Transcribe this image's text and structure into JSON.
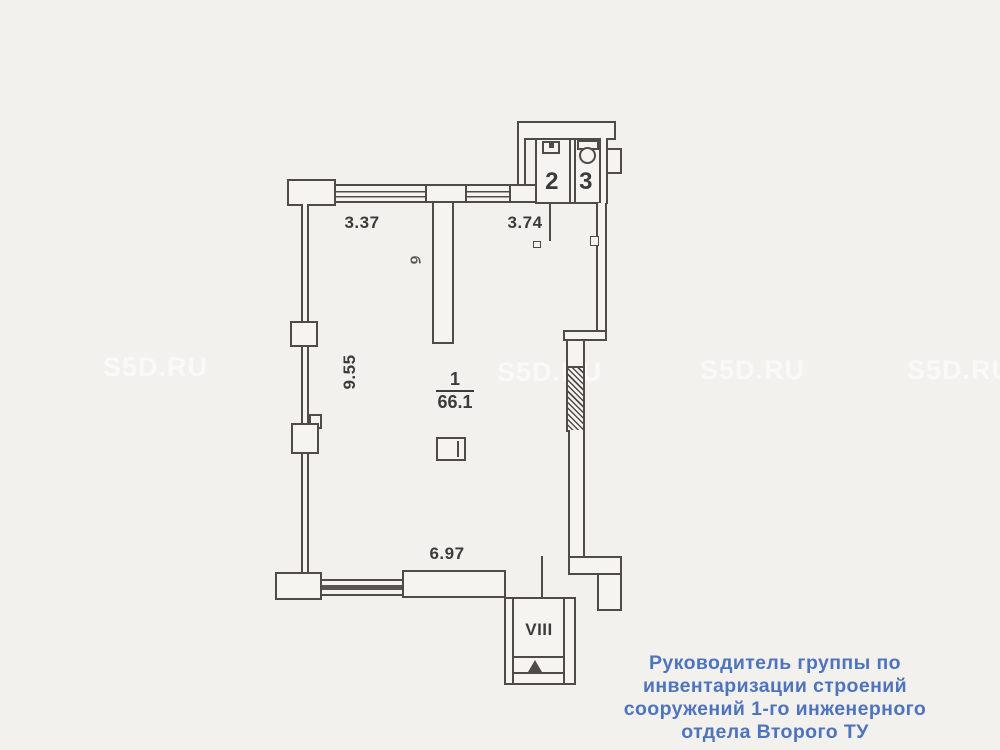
{
  "page": {
    "background": "#f3f1ee",
    "line_color": "#4f4b47"
  },
  "watermark": {
    "text": "S5D.RU"
  },
  "plan": {
    "room_main": {
      "number": "1",
      "area": "66.1"
    },
    "room_2": {
      "number": "2"
    },
    "room_3": {
      "number": "3"
    },
    "room_viii": {
      "number": "VIII"
    },
    "dims": {
      "top_left": "3.37",
      "top_mid": "3.74",
      "left": "9.55",
      "bottom": "6.97"
    },
    "symbols": {
      "vent": "б"
    }
  },
  "caption": {
    "color": "#4e74bd",
    "lines": [
      "Руководитель группы по",
      "инвентаризации строений",
      "сооружений 1-го инженерного",
      "отдела Второго ТУ"
    ]
  }
}
